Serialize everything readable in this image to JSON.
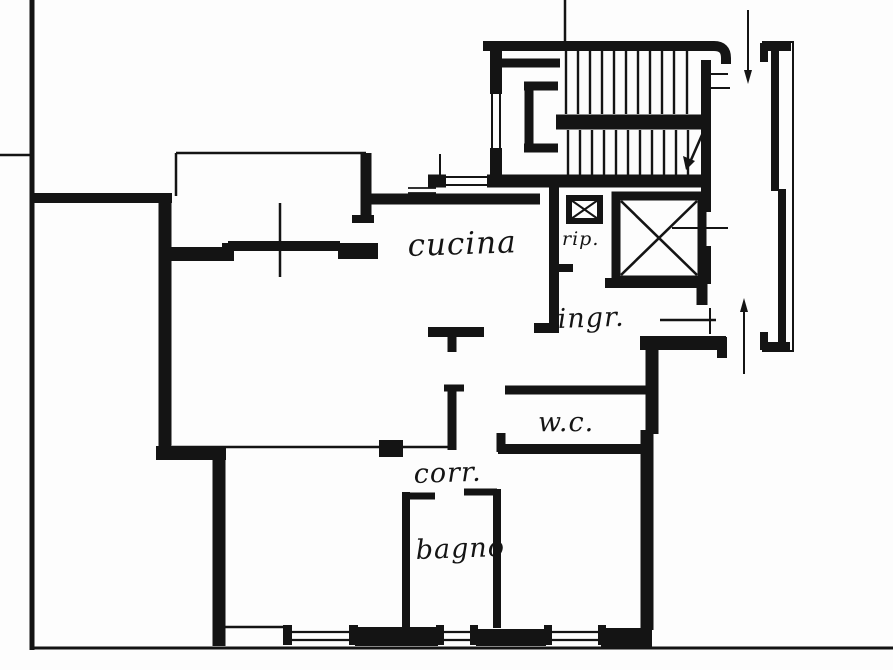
{
  "plan": {
    "paper_color": "#fdfdfd",
    "ink_color": "#141414",
    "room_labels": [
      {
        "id": "cucina",
        "label": "cucina"
      },
      {
        "id": "rip",
        "label": "rip."
      },
      {
        "id": "ingr",
        "label": "ingr."
      },
      {
        "id": "wc",
        "label": "w.c."
      },
      {
        "id": "corr",
        "label": "corr."
      },
      {
        "id": "bagno",
        "label": "bagno"
      }
    ]
  }
}
